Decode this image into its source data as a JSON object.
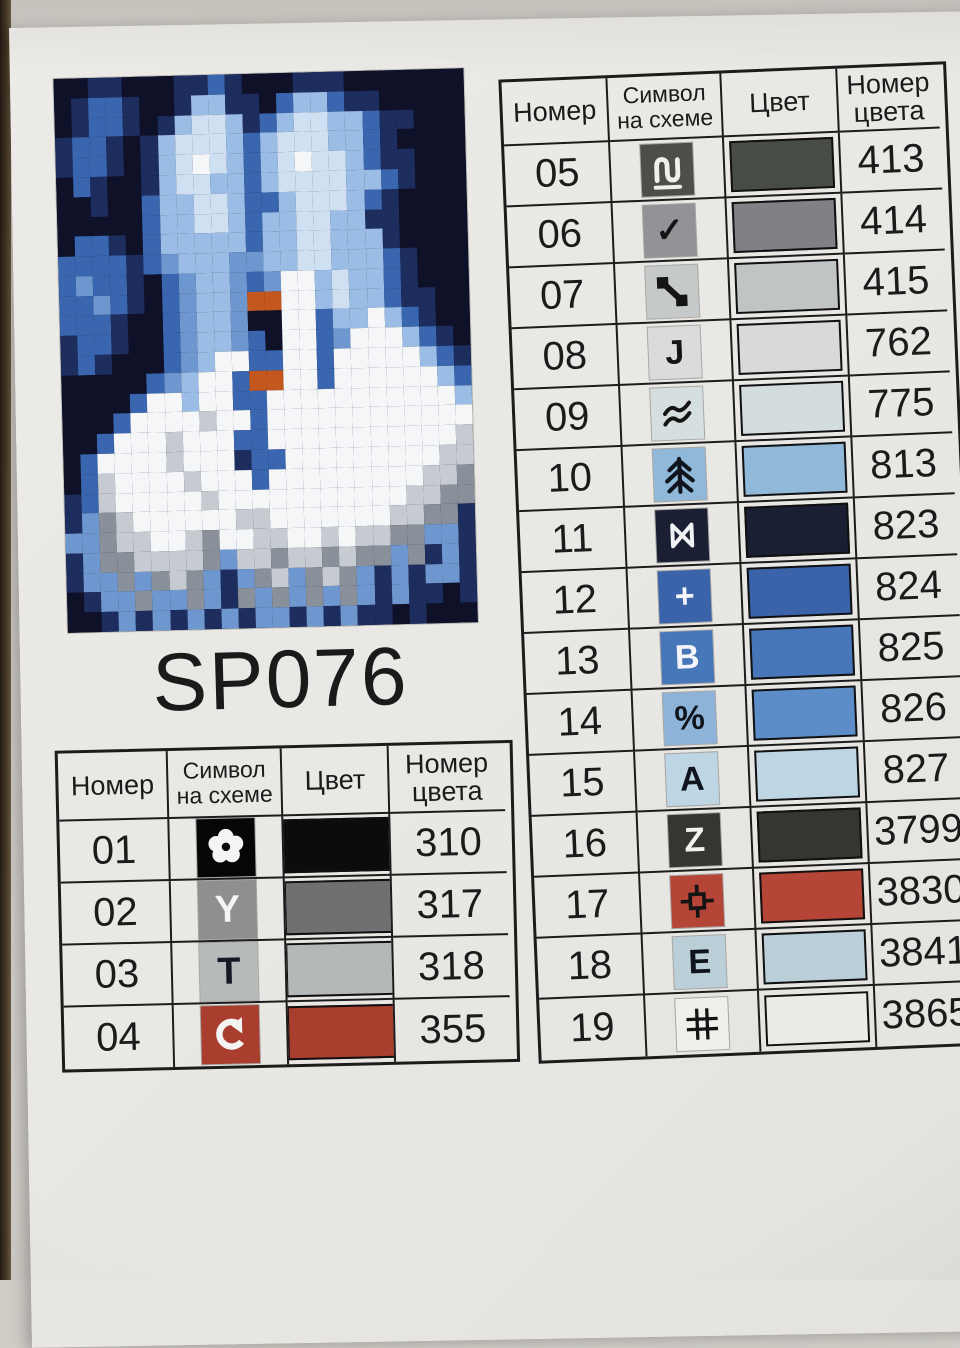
{
  "page": {
    "code": "SP076"
  },
  "headers": {
    "number": "Номер",
    "symbol_l1": "Символ",
    "symbol_l2": "на схеме",
    "color": "Цвет",
    "colnum_l1": "Номер",
    "colnum_l2": "цвета"
  },
  "left_table": {
    "rows": [
      {
        "number": "01",
        "symbol": "flower-icon",
        "glyph_type": "svg",
        "glyph": "",
        "chip_bg": "#060606",
        "glyph_color": "#f4f4f2",
        "swatch": "#0c0c0c",
        "color_number": "310"
      },
      {
        "number": "02",
        "symbol": "letter-y-symbol",
        "glyph_type": "text",
        "glyph": "Y",
        "chip_bg": "#8d8f90",
        "glyph_color": "#f4f4f2",
        "swatch": "#6e7072",
        "color_number": "317"
      },
      {
        "number": "03",
        "symbol": "letter-t-symbol",
        "glyph_type": "text",
        "glyph": "T",
        "chip_bg": "#b7babb",
        "glyph_color": "#181824",
        "swatch": "#b5b8b9",
        "color_number": "318"
      },
      {
        "number": "04",
        "symbol": "loop-arrow-icon",
        "glyph_type": "svg",
        "glyph": "",
        "chip_bg": "#a93d2e",
        "glyph_color": "#f4f4f2",
        "swatch": "#a93d2e",
        "color_number": "355"
      }
    ]
  },
  "right_table": {
    "rows": [
      {
        "number": "05",
        "symbol": "wave-n-icon",
        "glyph_type": "svg",
        "glyph": "",
        "chip_bg": "#4b4f47",
        "glyph_color": "#efefec",
        "swatch": "#484c46",
        "color_number": "413"
      },
      {
        "number": "06",
        "symbol": "checkmark-icon",
        "glyph_type": "text",
        "glyph": "✓",
        "chip_bg": "#929397",
        "glyph_color": "#141414",
        "swatch": "#7f8185",
        "color_number": "414"
      },
      {
        "number": "07",
        "symbol": "link-diagonal-icon",
        "glyph_type": "svg",
        "glyph": "",
        "chip_bg": "#c6c9ca",
        "glyph_color": "#141414",
        "swatch": "#c1c4c5",
        "color_number": "415"
      },
      {
        "number": "08",
        "symbol": "letter-j-symbol",
        "glyph_type": "text",
        "glyph": "J",
        "chip_bg": "#dadcdb",
        "glyph_color": "#141414",
        "swatch": "#d8dad9",
        "color_number": "762"
      },
      {
        "number": "09",
        "symbol": "double-wave-icon",
        "glyph_type": "svg",
        "glyph": "",
        "chip_bg": "#d6dfdf",
        "glyph_color": "#141414",
        "swatch": "#d4dddd",
        "color_number": "775"
      },
      {
        "number": "10",
        "symbol": "fir-tree-icon",
        "glyph_type": "svg",
        "glyph": "",
        "chip_bg": "#90b9d9",
        "glyph_color": "#10141c",
        "swatch": "#90b9d9",
        "color_number": "813"
      },
      {
        "number": "11",
        "symbol": "bowtie-icon",
        "glyph_type": "svg",
        "glyph": "",
        "chip_bg": "#1b1f33",
        "glyph_color": "#f2f2f4",
        "swatch": "#1b1f33",
        "color_number": "823"
      },
      {
        "number": "12",
        "symbol": "plus-symbol",
        "glyph_type": "text",
        "glyph": "+",
        "chip_bg": "#3b63a9",
        "glyph_color": "#f4f5f8",
        "swatch": "#3b63a9",
        "color_number": "824"
      },
      {
        "number": "13",
        "symbol": "letter-b-symbol",
        "glyph_type": "text",
        "glyph": "B",
        "chip_bg": "#4777b9",
        "glyph_color": "#f4f5f8",
        "swatch": "#4777b9",
        "color_number": "825"
      },
      {
        "number": "14",
        "symbol": "percent-symbol",
        "glyph_type": "text",
        "glyph": "%",
        "chip_bg": "#8db4d8",
        "glyph_color": "#10141c",
        "swatch": "#5d8dc9",
        "color_number": "826"
      },
      {
        "number": "15",
        "symbol": "letter-a-symbol",
        "glyph_type": "text",
        "glyph": "A",
        "chip_bg": "#bed6e3",
        "glyph_color": "#10141c",
        "swatch": "#bed6e3",
        "color_number": "827"
      },
      {
        "number": "16",
        "symbol": "letter-z-symbol",
        "glyph_type": "text",
        "glyph": "Z",
        "chip_bg": "#36352f",
        "glyph_color": "#f2f2ef",
        "swatch": "#36352f",
        "color_number": "3799"
      },
      {
        "number": "17",
        "symbol": "target-box-icon",
        "glyph_type": "svg",
        "glyph": "",
        "chip_bg": "#b54537",
        "glyph_color": "#141414",
        "swatch": "#b54537",
        "color_number": "3830"
      },
      {
        "number": "18",
        "symbol": "letter-e-symbol",
        "glyph_type": "text",
        "glyph": "E",
        "chip_bg": "#bacfd8",
        "glyph_color": "#10141c",
        "swatch": "#bacfd8",
        "color_number": "3841"
      },
      {
        "number": "19",
        "symbol": "hash-grid-icon",
        "glyph_type": "svg",
        "glyph": "",
        "chip_bg": "#f0efeb",
        "glyph_color": "#141414",
        "swatch": "#edebe6",
        "color_number": "3865"
      }
    ]
  },
  "preview": {
    "description": "pixelated cross-stitch preview: kissing couple in blue tones above two white swans on water",
    "cols": 24,
    "palette": {
      "k": "#0e1128",
      "n": "#1d2d5e",
      "b": "#3a66b0",
      "s": "#6f97cf",
      "l": "#9bbce4",
      "p": "#cfe0f2",
      "w": "#f4f6f8",
      "g": "#c6cbd1",
      "d": "#8a9099",
      "o": "#c4571e"
    },
    "rows": [
      "kknnkkknnbnkkknnnkkkkkkk",
      "knbbnkknllnnkbllbnnkkkkk",
      "knbbnknlpplnblppllbnnkkk",
      "nbbnknlppplblpppllbnkkkk",
      "nbbnknlpwplblpwpplbnnkkk",
      "kbnkknlppllblppppllbnkkk",
      "kknkkbllpplbblppplbnkkkk",
      "kkkkkbllpplbllppllnnkkkk",
      "kbbnkblllllbllpplllnkkkk",
      "bbbbnbslllssllpplllbnkkk",
      "bsbbnkbsllsbswwlpllbnkkk",
      "bbsbnkbsllsoowwlpllbnnkk",
      "bbbnkkbsllskkwwbllwlbnkk",
      "nbbnkkbsllsbkwwbswwwlbnk",
      "nbnkkkbslwwbbwwbwwwwwlbn",
      "kkkkkbslwwboowwbwwwwwwlb",
      "kkkkbwwlwwbbwwwwwwwwwwwl",
      "kkkbwwwwgwwbwwwwwwwwwwww",
      "kkbwwwgwwwbbwwwwwwwwwwwg",
      "kbwwwwgwwwnbbwwwwwwwwwgg",
      "kbgwwwwgwwwbwwwwwwwwwggd",
      "nbgwwwwwgwwwwwwwwwwwggdd",
      "nsdgwwwwwwggwwwwwwwggddn",
      "ssdggwwgdwwggwwgwggddssn",
      "nsddggggdsggdggdgddsdnsn",
      "nssdsdgdsnsdgsdgdsnsnssn",
      "knssdssdsndsdsdsdsnsnnkn",
      "kknsnsnsnsnssnsnsnnknkkk"
    ]
  }
}
